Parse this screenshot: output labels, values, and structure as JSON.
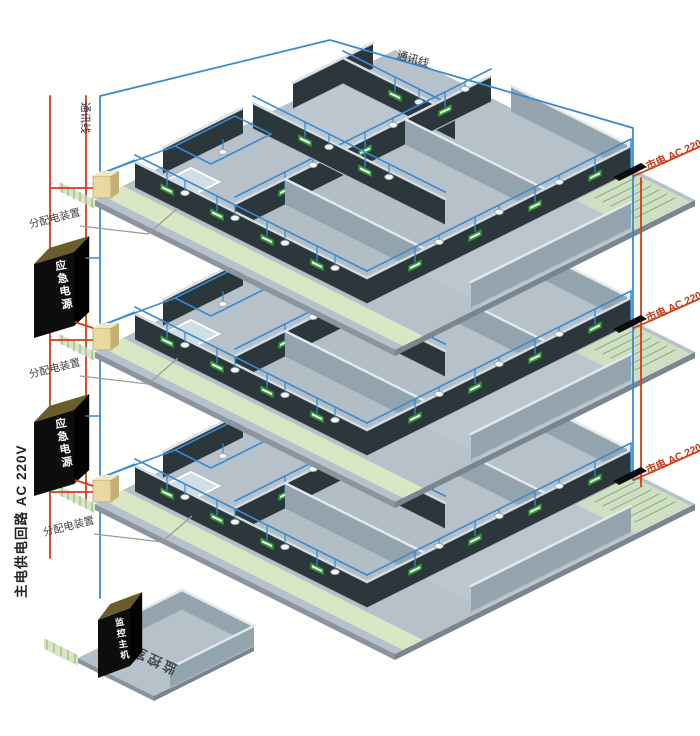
{
  "diagram": {
    "labels": {
      "comm_line_top": "通讯线",
      "comm_line_riser": "通讯线",
      "main_power_circuit": "主电供电回路 AC 220V",
      "distribution_device": "分配电装置",
      "emergency_power": "应急电源",
      "mains_power": "市电 AC 220V",
      "monitor_host": "监控主机",
      "monitor_room": "监控室"
    },
    "colors": {
      "comm_line": "#3a8ad2",
      "power_line": "#d63c12",
      "floor": "#b6c1c9",
      "wall_dark": "#2c373b",
      "wall_gray": "#93a4ae",
      "corridor_green": "#d8e6c4",
      "stair_green": "#cfe0c2",
      "distribution_box": "#e9d8a0",
      "device_black": "#0d0d0d",
      "exit_sign_green": "#3f9a45",
      "label_red": "#c43b18"
    },
    "floors": [
      {
        "name": "floor-1",
        "origin_y": 200,
        "dist_label_pos": [
          30,
          228
        ],
        "mains_label_pos": [
          648,
          170
        ]
      },
      {
        "name": "floor-2",
        "origin_y": 352,
        "dist_label_pos": [
          30,
          378
        ],
        "mains_label_pos": [
          648,
          322
        ]
      },
      {
        "name": "floor-3",
        "origin_y": 504,
        "dist_label_pos": [
          44,
          536
        ],
        "mains_label_pos": [
          648,
          474
        ]
      }
    ],
    "emergency_boxes": [
      {
        "name": "emergency-power-box-1",
        "top_y": 248
      },
      {
        "name": "emergency-power-box-2",
        "top_y": 406
      }
    ],
    "monitor_room_origin": [
      78,
      658
    ]
  }
}
